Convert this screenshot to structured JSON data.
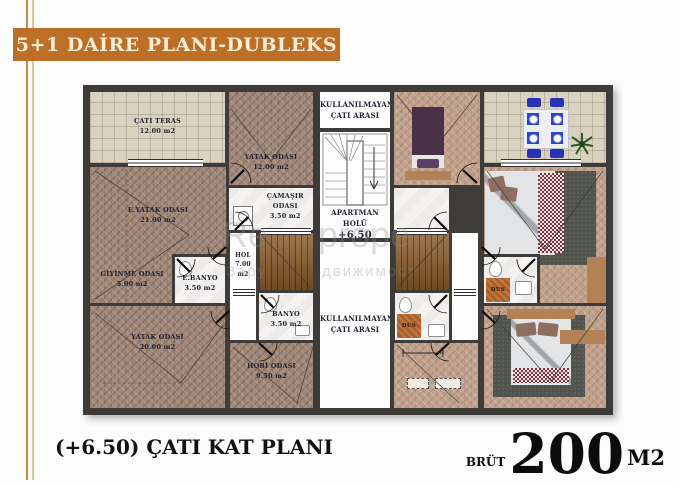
{
  "banner": {
    "title": "5+1 DAİRE PLANI-DUBLEKS"
  },
  "rooms": {
    "cati_teras": {
      "name": "ÇATI TERAS",
      "area": "12.00 m2"
    },
    "yatak_ust": {
      "name": "YATAK ODASI",
      "area": "12.00 m2"
    },
    "e_yatak": {
      "name": "E.YATAK ODASI",
      "area": "21.00 m2"
    },
    "camasir": {
      "line1": "ÇAMAŞIR",
      "line2": "ODASI",
      "area": "3.50 m2"
    },
    "giyinme": {
      "name": "GİYİNME ODASI",
      "area": "5.00 m2"
    },
    "e_banyo": {
      "name": "E.BANYO",
      "area": "3.50 m2"
    },
    "hol": {
      "name": "HOL",
      "area": "7.00 m2"
    },
    "banyo": {
      "name": "BANYO",
      "area": "3.50 m2"
    },
    "yatak_alt": {
      "name": "YATAK ODASI",
      "area": "20.00 m2"
    },
    "hobi": {
      "name": "HOBİ ODASI",
      "area": "9.50 m2"
    },
    "kullanilmayan_ust": {
      "line1": "KULLANILMAYAN",
      "line2": "ÇATI ARASI"
    },
    "kullanilmayan_alt": {
      "line1": "KULLANILMAYAN",
      "line2": "ÇATI ARASI"
    },
    "apartman_holu": {
      "line1": "APARTMAN",
      "line2": "HOLÜ",
      "level": "+6.50"
    },
    "dus_1": {
      "name": "DUS"
    },
    "dus_2": {
      "name": "DUS"
    }
  },
  "watermark": {
    "frag1": "Re",
    "frag2": "prope",
    "frag3": "Зару",
    "frag4": "движимост"
  },
  "footer": {
    "title": "(+6.50) ÇATI KAT PLANI",
    "brut": "BRÜT",
    "area": "200",
    "unit": "M2"
  },
  "colors": {
    "banner_bg": "#bd6f28",
    "accent_line_dark": "#c8863f",
    "accent_line_light": "#dcc49c",
    "wall": "#3e3c38",
    "wood_left": "#a18878",
    "wood_right": "#c1a28d",
    "tile": "#d9d2c0",
    "shower_orange": "#ad6028",
    "bed_purple": "#4a3049",
    "chair_blue": "#2732b5",
    "rug": "#50544d",
    "label_text": "#1f2030"
  }
}
